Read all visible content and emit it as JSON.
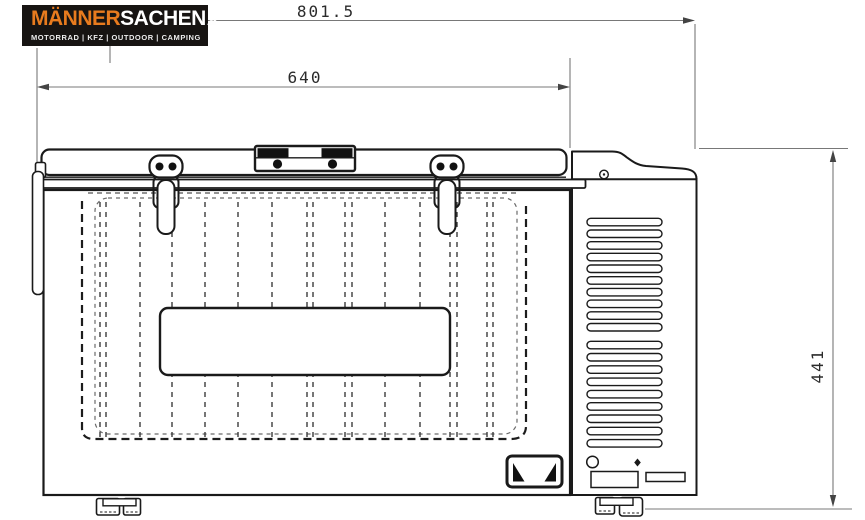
{
  "logo": {
    "brand_primary": "MÄNNER",
    "brand_secondary": "SACHEN",
    "brand_tld": ".at",
    "tagline": "MOTORRAD | KFZ | OUTDOOR | CAMPING",
    "colors": {
      "accent_orange": "#e87b1e",
      "background": "#171412",
      "text": "#ffffff"
    }
  },
  "drawing": {
    "subject": "chest cool box front elevation technical drawing",
    "dimensions": [
      {
        "id": "outer-width",
        "value": "801.5",
        "orientation": "horizontal"
      },
      {
        "id": "lid-width",
        "value": "640",
        "orientation": "horizontal"
      },
      {
        "id": "height",
        "value": "441",
        "orientation": "vertical"
      }
    ],
    "colors": {
      "outline": "#1a1a1a",
      "dimension_lines": "#787878",
      "hidden_lines": "#3c3c3c"
    }
  }
}
